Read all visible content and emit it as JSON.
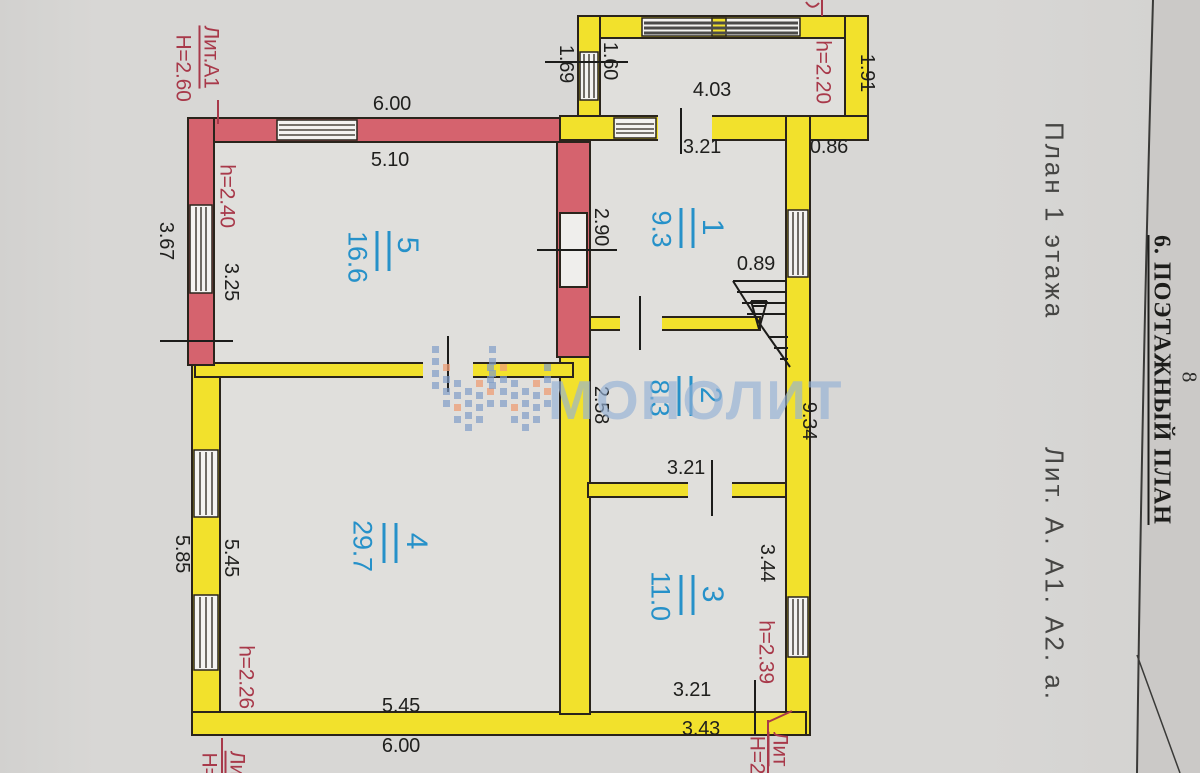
{
  "page": {
    "section_title": "6. ПОЭТАЖНЫЙ ПЛАН",
    "page_number": "8",
    "caption_left": "План 1 этажа",
    "caption_right": "Лит. А. А1. А2. а."
  },
  "watermark": {
    "text": "МОНОЛИТ"
  },
  "rooms": [
    {
      "number": "1",
      "area": "9.3"
    },
    {
      "number": "2",
      "area": "8.3"
    },
    {
      "number": "3",
      "area": "11.0"
    },
    {
      "number": "4",
      "area": "29.7"
    },
    {
      "number": "5",
      "area": "16.6"
    }
  ],
  "labels": {
    "d403": "4.03",
    "d600t": "6.00",
    "d510": "5.10",
    "d321t": "3.21",
    "d086": "0.86",
    "d089": "0.89",
    "d321m": "3.21",
    "d321b": "3.21",
    "d343": "3.43",
    "d545b": "5.45",
    "d600b": "6.00",
    "d169": "1.69",
    "d160": "1.60",
    "d191": "1.91",
    "d367": "3.67",
    "d325": "3.25",
    "d290": "2.90",
    "d258": "2.58",
    "d934": "9.34",
    "d344": "3.44",
    "d585": "5.85",
    "d545l": "5.45",
    "h220": "h=2.20",
    "h240": "h=2.40",
    "h226": "h=2.26",
    "h239": "h=2.39",
    "litA1": "Лит.А1",
    "H260": "Н=2.60",
    "lit_br": "Лит",
    "H2_br": "Н=2",
    "lit_bl": "Лит",
    "H_bl": "Н=",
    "top_partial": "4.12"
  },
  "colors": {
    "wall_old": "#d5636e",
    "wall_new": "#f2e12c",
    "room_label_blue": "#2691c9",
    "annotation_red": "#a8394a"
  }
}
